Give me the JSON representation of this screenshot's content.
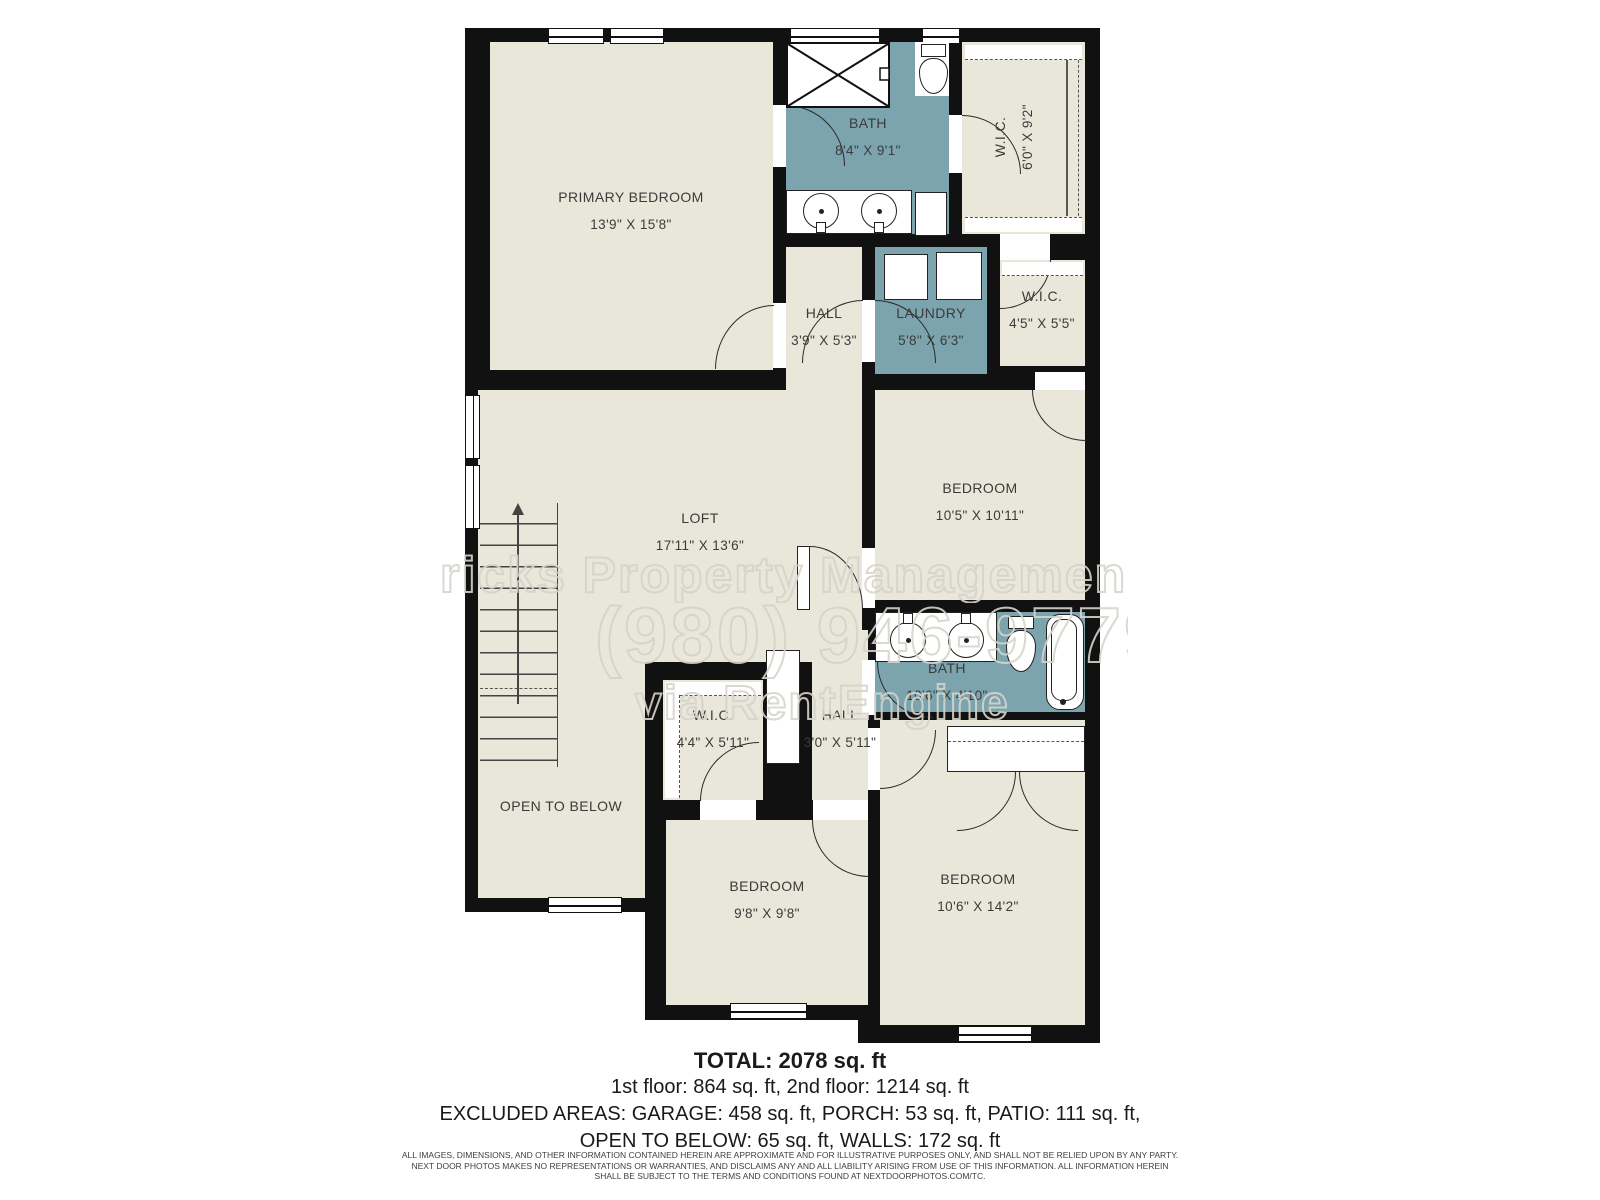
{
  "floorplan": {
    "rooms": [
      {
        "id": "primary-bedroom",
        "name": "PRIMARY BEDROOM",
        "dims": "13'9\" X 15'8\""
      },
      {
        "id": "bath-upper",
        "name": "BATH",
        "dims": "8'4\" X 9'1\""
      },
      {
        "id": "wic-primary",
        "name": "W.I.C.",
        "dims": "6'0\" X 9'2\""
      },
      {
        "id": "hall-upper",
        "name": "HALL",
        "dims": "3'9\" X 5'3\""
      },
      {
        "id": "laundry",
        "name": "LAUNDRY",
        "dims": "5'8\" X 6'3\""
      },
      {
        "id": "wic-2",
        "name": "W.I.C.",
        "dims": "4'5\" X 5'5\""
      },
      {
        "id": "loft",
        "name": "LOFT",
        "dims": "17'11\" X 13'6\""
      },
      {
        "id": "bedroom-mid",
        "name": "BEDROOM",
        "dims": "10'5\" X 10'11\""
      },
      {
        "id": "bath-lower",
        "name": "BATH",
        "dims": "10'6\" X 4'10\""
      },
      {
        "id": "wic-3",
        "name": "W.I.C.",
        "dims": "4'4\" X 5'11\""
      },
      {
        "id": "hall-lower",
        "name": "HALL",
        "dims": "3'0\" X 5'11\""
      },
      {
        "id": "open-below",
        "name": "OPEN TO BELOW",
        "dims": ""
      },
      {
        "id": "bedroom-bottom-center",
        "name": "BEDROOM",
        "dims": "9'8\" X 9'8\""
      },
      {
        "id": "bedroom-bottom-right",
        "name": "BEDROOM",
        "dims": "10'6\" X 14'2\""
      }
    ],
    "watermark": {
      "line1": "ricks Property Managemen",
      "line2": "(980) 946-9779",
      "line3": "via RentEngine"
    },
    "summary": {
      "total": "TOTAL: 2078 sq. ft",
      "floors": "1st floor: 864 sq. ft, 2nd floor: 1214 sq. ft",
      "excluded1": "EXCLUDED AREAS: GARAGE: 458 sq. ft, PORCH: 53 sq. ft, PATIO: 111 sq. ft,",
      "excluded2": "OPEN TO BELOW: 65 sq. ft, WALLS: 172 sq. ft"
    },
    "disclaimer": {
      "line1": "ALL IMAGES, DIMENSIONS, AND OTHER INFORMATION CONTAINED HEREIN ARE APPROXIMATE AND FOR ILLUSTRATIVE PURPOSES ONLY, AND SHALL NOT BE RELIED UPON BY ANY PARTY.",
      "line2": "NEXT DOOR PHOTOS MAKES NO REPRESENTATIONS OR WARRANTIES, AND DISCLAIMS ANY AND ALL LIABILITY ARISING FROM USE OF THIS INFORMATION. ALL INFORMATION HEREIN",
      "line3": "SHALL BE SUBJECT TO THE TERMS AND CONDITIONS FOUND AT NEXTDOORPHOTOS.COM/TC."
    },
    "colors": {
      "wall": "#111111",
      "floor": "#e9e6da",
      "wet_room": "#7ba4af",
      "label": "#3b3b39"
    }
  }
}
